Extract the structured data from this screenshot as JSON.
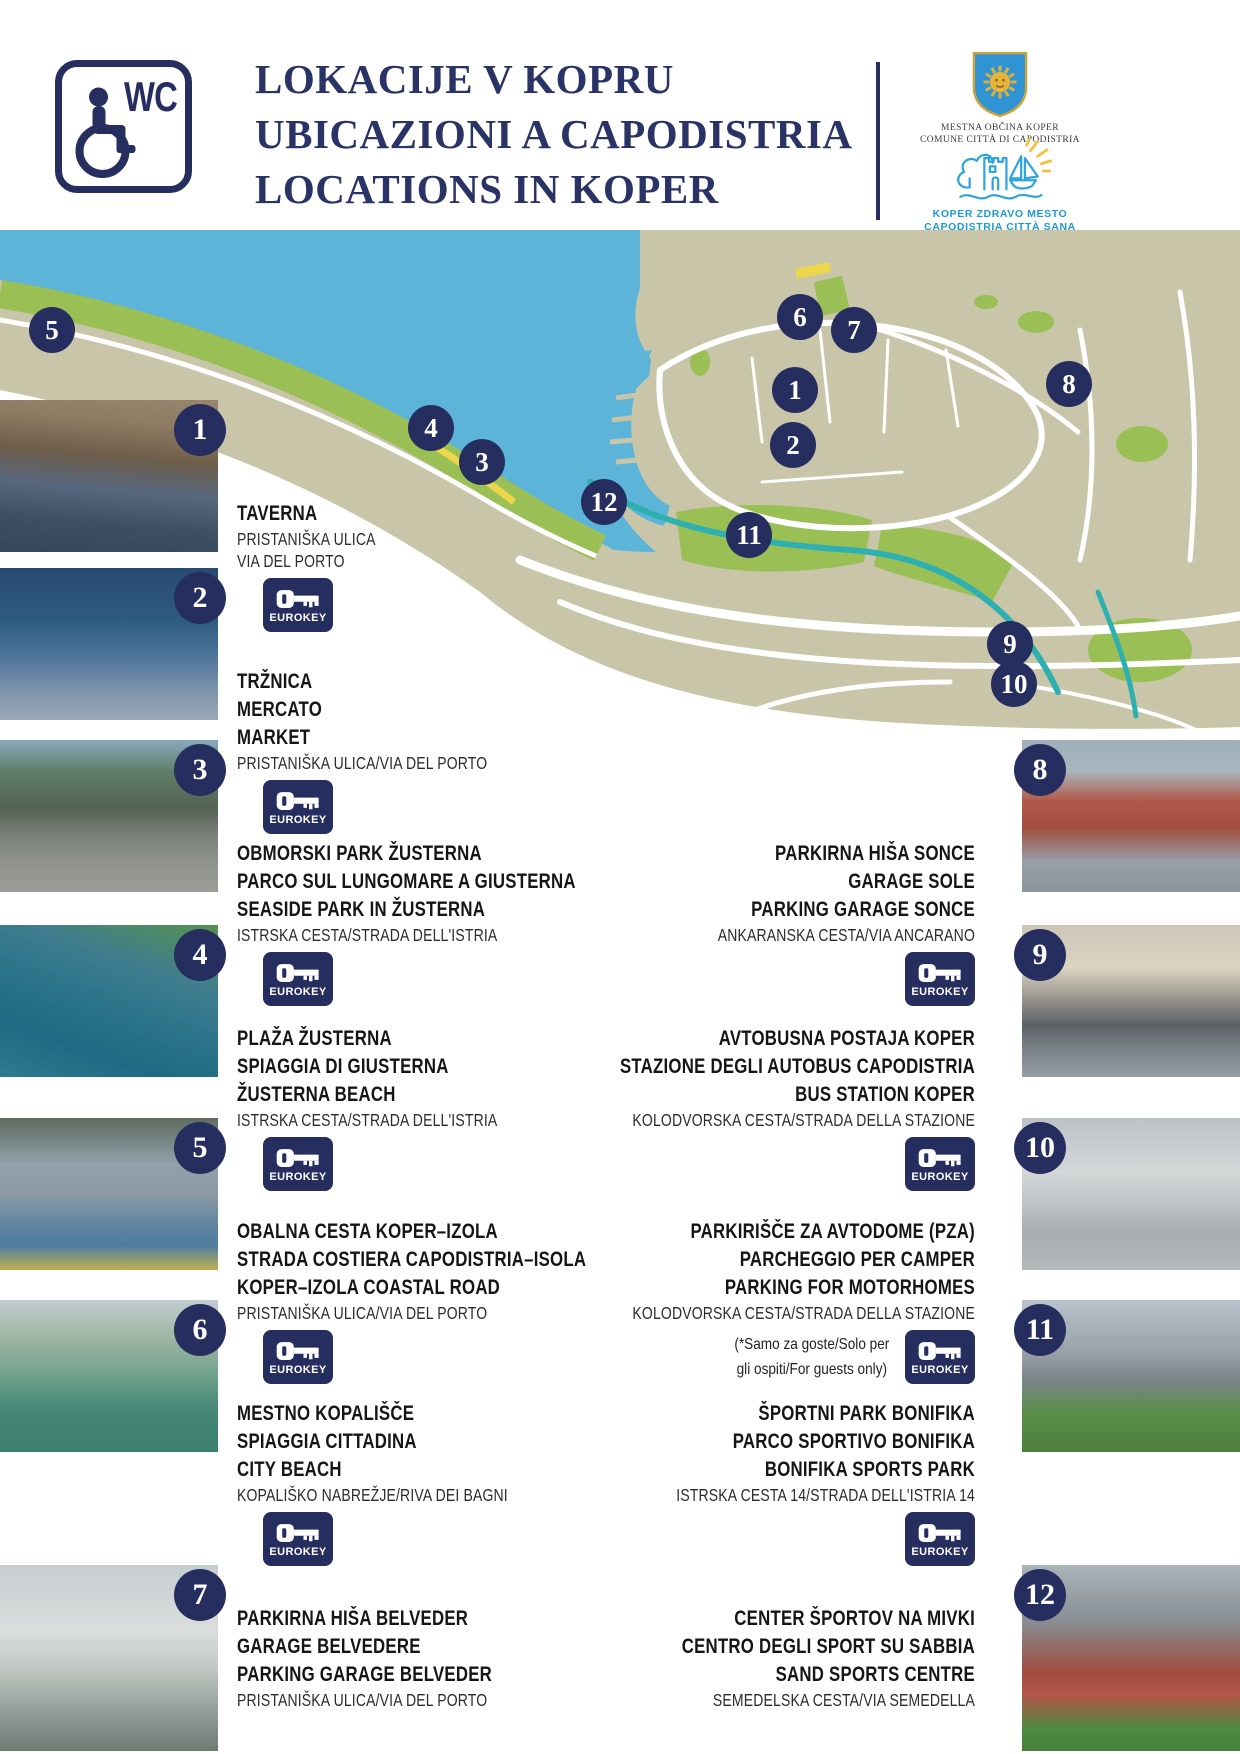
{
  "header": {
    "wc_label": "WC",
    "title_lines": [
      "LOKACIJE V KOPRU",
      "UBICAZIONI A CAPODISTRIA",
      "LOCATIONS IN KOPER"
    ],
    "municipality_logo": {
      "line1": "MESTNA OBČINA KOPER",
      "line2": "COMUNE CITTÀ DI CAPODISTRIA"
    },
    "healthy_city_logo": {
      "line1": "KOPER ZDRAVO MESTO",
      "line2": "CAPODISTRIA CITTÀ SANA"
    }
  },
  "eurokey_label": "EUROKEY",
  "map": {
    "colors": {
      "sea": "#5cb4d8",
      "land": "#c8c5a8",
      "park": "#9abf55",
      "road": "#ffffff",
      "water_channel": "#2fb0b0",
      "beach": "#ecd64c",
      "marker": "#262e60"
    },
    "markers": [
      {
        "number": "5",
        "x": 52,
        "y": 100
      },
      {
        "number": "4",
        "x": 431,
        "y": 198
      },
      {
        "number": "3",
        "x": 482,
        "y": 232
      },
      {
        "number": "6",
        "x": 800,
        "y": 87
      },
      {
        "number": "7",
        "x": 854,
        "y": 100
      },
      {
        "number": "1",
        "x": 795,
        "y": 160
      },
      {
        "number": "2",
        "x": 793,
        "y": 215
      },
      {
        "number": "8",
        "x": 1069,
        "y": 154
      },
      {
        "number": "12",
        "x": 604,
        "y": 272
      },
      {
        "number": "11",
        "x": 749,
        "y": 305
      },
      {
        "number": "9",
        "x": 1010,
        "y": 414
      },
      {
        "number": "10",
        "x": 1014,
        "y": 454
      }
    ]
  },
  "locations": [
    {
      "number": "1",
      "names": [
        "TAVERNA"
      ],
      "address_lines": [
        "PRISTANIŠKA ULICA",
        "VIA DEL PORTO"
      ],
      "eurokey": true
    },
    {
      "number": "2",
      "names": [
        "TRŽNICA",
        "MERCATO",
        "MARKET"
      ],
      "address_lines": [
        "PRISTANIŠKA ULICA/VIA DEL PORTO"
      ],
      "eurokey": true
    },
    {
      "number": "3",
      "names": [
        "OBMORSKI PARK ŽUSTERNA",
        "PARCO SUL LUNGOMARE A GIUSTERNA",
        "SEASIDE PARK IN ŽUSTERNA"
      ],
      "address_lines": [
        "ISTRSKA CESTA/STRADA DELL'ISTRIA"
      ],
      "eurokey": true
    },
    {
      "number": "4",
      "names": [
        "PLAŽA ŽUSTERNA",
        "SPIAGGIA DI GIUSTERNA",
        "ŽUSTERNA BEACH"
      ],
      "address_lines": [
        "ISTRSKA CESTA/STRADA DELL'ISTRIA"
      ],
      "eurokey": true
    },
    {
      "number": "5",
      "names": [
        "OBALNA CESTA KOPER–IZOLA",
        "STRADA COSTIERA CAPODISTRIA–ISOLA",
        "KOPER–IZOLA COASTAL ROAD"
      ],
      "address_lines": [
        "PRISTANIŠKA ULICA/VIA DEL PORTO"
      ],
      "eurokey": true
    },
    {
      "number": "6",
      "names": [
        "MESTNO KOPALIŠČE",
        "SPIAGGIA CITTADINA",
        "CITY BEACH"
      ],
      "address_lines": [
        "KOPALIŠKO NABREŽJE/RIVA DEI BAGNI"
      ],
      "eurokey": true
    },
    {
      "number": "7",
      "names": [
        "PARKIRNA HIŠA BELVEDER",
        "GARAGE BELVEDERE",
        "PARKING GARAGE BELVEDER"
      ],
      "address_lines": [
        "PRISTANIŠKA ULICA/VIA DEL PORTO"
      ],
      "eurokey": false
    },
    {
      "number": "8",
      "names": [
        "PARKIRNA HIŠA SONCE",
        "GARAGE SOLE",
        "PARKING GARAGE SONCE"
      ],
      "address_lines": [
        "ANKARANSKA CESTA/VIA ANCARANO"
      ],
      "eurokey": true
    },
    {
      "number": "9",
      "names": [
        "AVTOBUSNA POSTAJA KOPER",
        "STAZIONE DEGLI AUTOBUS CAPODISTRIA",
        "BUS STATION KOPER"
      ],
      "address_lines": [
        "KOLODVORSKA CESTA/STRADA DELLA STAZIONE"
      ],
      "eurokey": true
    },
    {
      "number": "10",
      "names": [
        "PARKIRIŠČE ZA AVTODOME (PZA)",
        "PARCHEGGIO PER CAMPER",
        "PARKING FOR MOTORHOMES"
      ],
      "address_lines": [
        "KOLODVORSKA CESTA/STRADA DELLA STAZIONE"
      ],
      "note_lines": [
        "(*Samo za goste/Solo per",
        "gli ospiti/For guests only)"
      ],
      "eurokey": true
    },
    {
      "number": "11",
      "names": [
        "ŠPORTNI PARK BONIFIKA",
        "PARCO SPORTIVO BONIFIKA",
        "BONIFIKA SPORTS PARK"
      ],
      "address_lines": [
        "ISTRSKA CESTA 14/STRADA DELL'ISTRIA 14"
      ],
      "eurokey": true
    },
    {
      "number": "12",
      "names": [
        "CENTER ŠPORTOV NA MIVKI",
        "CENTRO DEGLI SPORT SU SABBIA",
        "SAND SPORTS CENTRE"
      ],
      "address_lines": [
        "SEMEDELSKA CESTA/VIA SEMEDELLA"
      ],
      "eurokey": false
    }
  ]
}
